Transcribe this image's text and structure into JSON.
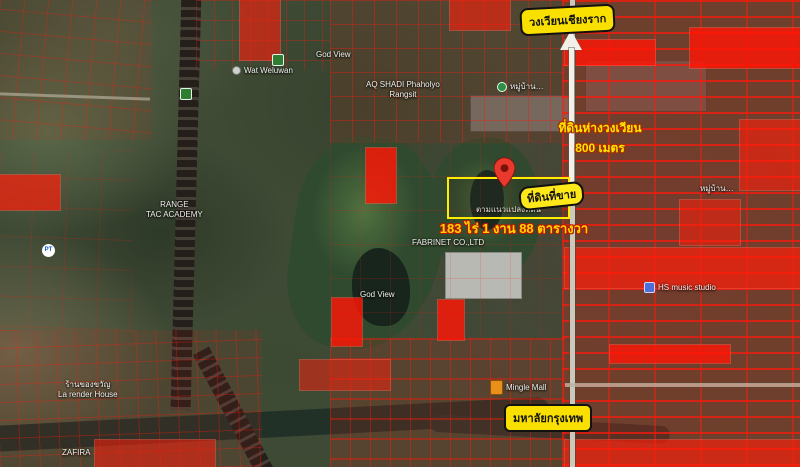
{
  "map": {
    "overlay": {
      "roundabout_label": "วงเวียนเชียงราก",
      "distance_line1": "ที่ดินห่างวงเวียน",
      "distance_line2": "800 เมตร",
      "pin_label": "ที่ดินที่ขาย",
      "parcel_caption": "ตามแนวแปลงที่ดิน",
      "area_text": "183 ไร่ 1 งาน 88 ตารางวา",
      "university_label": "มหาลัยกรุงเทพ"
    },
    "pois": [
      {
        "name": "poi-wat-weluwan",
        "label": "Wat Weluwan",
        "x": 232,
        "y": 66,
        "icon": "dot"
      },
      {
        "name": "poi-god-view-north",
        "label": "God View",
        "x": 316,
        "y": 50
      },
      {
        "name": "poi-aq-shadi",
        "lines": [
          "AQ SHADI Phaholyo",
          "Rangsit"
        ],
        "x": 366,
        "y": 80,
        "cls": "center"
      },
      {
        "name": "poi-village-north",
        "label": "หมู่บ้าน…",
        "x": 497,
        "y": 82,
        "icon": "dot-green"
      },
      {
        "name": "poi-fabrinet",
        "label": "FABRINET CO.,LTD",
        "x": 412,
        "y": 238
      },
      {
        "name": "poi-god-view-mid",
        "label": "God View",
        "x": 360,
        "y": 290
      },
      {
        "name": "poi-hs-music",
        "label": "HS music studio",
        "x": 644,
        "y": 282,
        "icon": "music"
      },
      {
        "name": "poi-village-east",
        "label": "หมู่บ้าน…",
        "x": 700,
        "y": 184
      },
      {
        "name": "poi-mingle-mall",
        "label": "Mingle Mall",
        "x": 490,
        "y": 380,
        "icon": "bag"
      },
      {
        "name": "poi-la-render-house",
        "lines": [
          "ร้านของขวัญ",
          "La render House"
        ],
        "x": 58,
        "y": 380,
        "cls": "center"
      },
      {
        "name": "poi-zafira",
        "label": "ZAFIRA",
        "x": 62,
        "y": 448
      },
      {
        "name": "poi-pt-station",
        "icon": "pt",
        "icon_text": "PT",
        "x": 42,
        "y": 244
      },
      {
        "name": "poi-tac-academy",
        "lines": [
          "RANGE",
          "TAC ACADEMY"
        ],
        "x": 146,
        "y": 200,
        "cls": "center"
      }
    ],
    "colors": {
      "bubble_yellow": "#f9e000",
      "label_yellow": "#ffe400",
      "area_text_yellow": "#ffd400",
      "area_outline_red": "#b71c00",
      "pin_red": "#e8392c",
      "parcel_line_red": "#ff1e0a",
      "parcel_frame_yellow": "#ffec00",
      "road_white": "#cdc9ba"
    }
  }
}
